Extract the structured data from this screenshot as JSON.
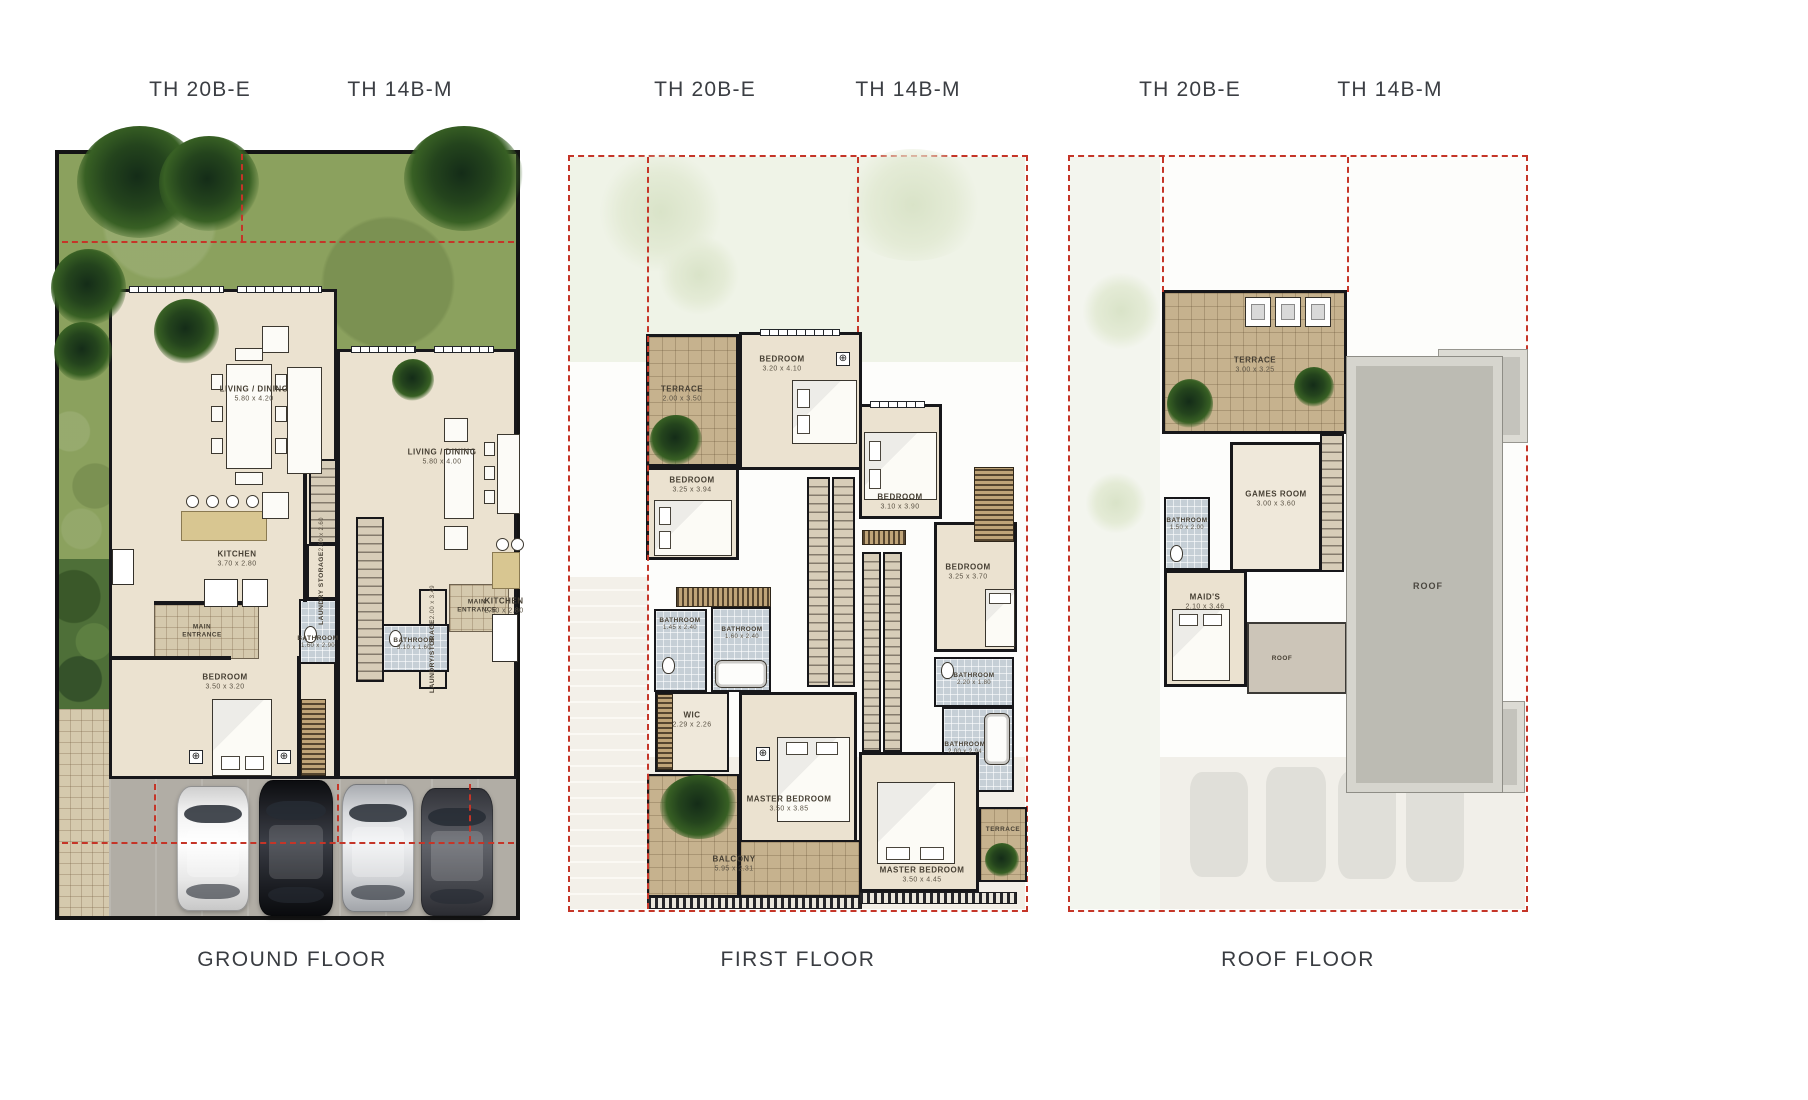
{
  "sheet_title": "Townhouse floor plans",
  "icons": {
    "register": "⊕"
  },
  "palette": {
    "boundary_dash_red": "#c53528",
    "wall_black": "#17171a",
    "grass_green": "#8ba15e",
    "floor_beige": "#ebe2d0",
    "terrace_tile_tan": "#c6b28e",
    "bathroom_blue": "#c6cfd6",
    "roof_gray": "#bcbbb3",
    "driveway_gray": "#b1ada5"
  },
  "panels": [
    {
      "caption": "GROUND FLOOR",
      "units": [
        "TH 20B-E",
        "TH 14B-M"
      ],
      "rooms": [
        {
          "label": "LIVING / DINING",
          "dims": "5.80 x 4.20"
        },
        {
          "label": "KITCHEN",
          "dims": "3.70 x 2.80"
        },
        {
          "label": "LAUNDRY STORAGE",
          "dims": "2.00 x 2.60"
        },
        {
          "label": "MAIN ENTRANCE",
          "dims": ""
        },
        {
          "label": "BATHROOM",
          "dims": "1.60 x 2.90"
        },
        {
          "label": "BEDROOM",
          "dims": "3.50 x 3.20"
        },
        {
          "label": "LIVING / DINING",
          "dims": "5.80 x 4.00"
        },
        {
          "label": "LAUNDRY/STORAGE",
          "dims": "2.00 x 3.49"
        },
        {
          "label": "KITCHEN",
          "dims": "2.50 x 2.80"
        },
        {
          "label": "BATHROOM",
          "dims": "3.10 x 1.60"
        },
        {
          "label": "MAIN ENTRANCE",
          "dims": ""
        }
      ]
    },
    {
      "caption": "FIRST FLOOR",
      "units": [
        "TH 20B-E",
        "TH 14B-M"
      ],
      "rooms": [
        {
          "label": "TERRACE",
          "dims": "2.00 x 3.50"
        },
        {
          "label": "BEDROOM",
          "dims": "3.20 x 4.10"
        },
        {
          "label": "BEDROOM",
          "dims": "3.25 x 3.94"
        },
        {
          "label": "BATHROOM",
          "dims": "1.45 x 2.40"
        },
        {
          "label": "BATHROOM",
          "dims": "1.60 x 2.40"
        },
        {
          "label": "WIC",
          "dims": "2.29 x 2.26"
        },
        {
          "label": "MASTER BEDROOM",
          "dims": "3.50 x 3.85"
        },
        {
          "label": "BALCONY",
          "dims": "5.95 x 2.31"
        },
        {
          "label": "BEDROOM",
          "dims": "3.10 x 3.90"
        },
        {
          "label": "BEDROOM",
          "dims": "3.25 x 3.70"
        },
        {
          "label": "BATHROOM",
          "dims": "2.20 x 1.80"
        },
        {
          "label": "BATHROOM",
          "dims": "2.00 x 2.94"
        },
        {
          "label": "MASTER BEDROOM",
          "dims": "3.50 x 4.45"
        },
        {
          "label": "TERRACE",
          "dims": ""
        }
      ]
    },
    {
      "caption": "ROOF FLOOR",
      "units": [
        "TH 20B-E",
        "TH 14B-M"
      ],
      "rooms": [
        {
          "label": "TERRACE",
          "dims": "3.00 x 3.25"
        },
        {
          "label": "GAMES ROOM",
          "dims": "3.00 x 3.60"
        },
        {
          "label": "BATHROOM",
          "dims": "1.50 x 2.00"
        },
        {
          "label": "MAID'S",
          "dims": "2.10 x 3.46"
        },
        {
          "label": "ROOF",
          "dims": ""
        },
        {
          "label": "ROOF",
          "dims": ""
        }
      ]
    }
  ]
}
